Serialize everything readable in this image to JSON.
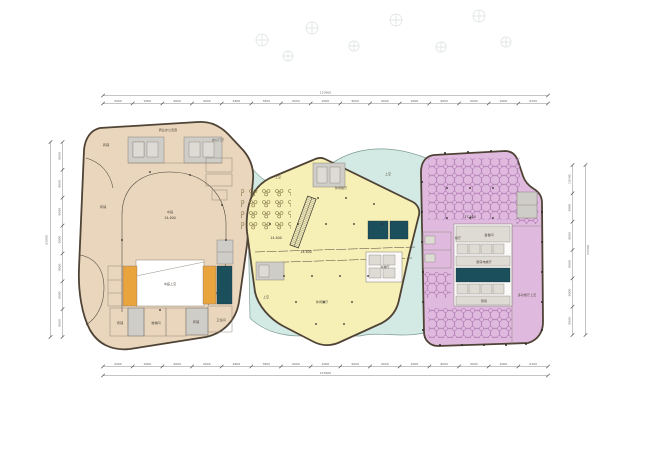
{
  "colors": {
    "tan": "#e9d6bc",
    "yellow": "#f6efb6",
    "purple": "#dfbade",
    "teal": "#d3eae4",
    "tealedge": "#7d9c94",
    "outline": "#4f4336",
    "shaft": "#1b4f5c",
    "orange": "#eaa43e",
    "core": "#cfcdc8",
    "dim": "#8a8a8a",
    "furniture_purple": "#a76fab",
    "furniture_olive": "#7c7040"
  },
  "dims": {
    "top": {
      "total": "123900",
      "segments": [
        "4400",
        "9000",
        "9000",
        "9000",
        "6600",
        "7800",
        "9000",
        "9000",
        "9000",
        "9000",
        "9000",
        "9000",
        "9000",
        "9000",
        "6100"
      ]
    },
    "bottom": {
      "total": "123900",
      "segments": [
        "4400",
        "9000",
        "9000",
        "9000",
        "6600",
        "7800",
        "9000",
        "9000",
        "9000",
        "9000",
        "9000",
        "9000",
        "9000",
        "9000",
        "6100"
      ]
    },
    "left": {
      "total": "63000",
      "segments": [
        "9000",
        "9000",
        "9000",
        "9000",
        "9000",
        "9000",
        "9000"
      ]
    },
    "right": {
      "total": "55500",
      "segments": [
        "10500",
        "9000",
        "9000",
        "9000",
        "9000",
        "9000"
      ]
    }
  },
  "labels": {
    "tan_corridor": "商业办公走廊",
    "tan_shop_top": "商铺",
    "tan_office_lobby": "办公门厅",
    "tan_shop_left": "商铺",
    "tan_atrium": "中庭",
    "tan_elev": "14.400",
    "tan_void": "中庭上空",
    "tan_shop_b1": "商铺",
    "tan_stair_b": "楼梯间",
    "tan_shop_b2": "商铺",
    "tan_wc": "卫生间",
    "teal_void_1": "上空",
    "teal_void_2": "上空",
    "teal_void_3": "上空",
    "yellow_restaurant": "休闲餐厅",
    "yellow_elev_1": "14.400",
    "yellow_elev_2": "14.400",
    "yellow_restaurant_2": "休闲餐厅",
    "yellow_lift_lobby": "客梯厅",
    "purple_elev": "17.400",
    "purple_dining": "餐厅",
    "purple_pantry": "备餐间",
    "purple_kitchen_lobby": "厨房电梯厅",
    "purple_kitchen": "厨房",
    "purple_hall_void": "多功能厅上空"
  }
}
